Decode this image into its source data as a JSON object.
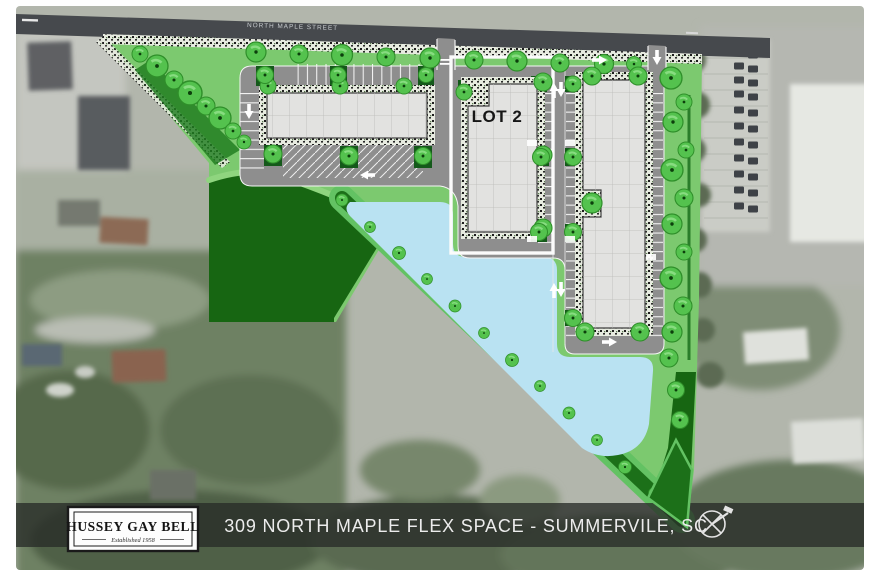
{
  "title_bar": {
    "text": "309 NORTH MAPLE FLEX SPACE - SUMMERVILE, SC"
  },
  "labels": {
    "street": "NORTH MAPLE STREET",
    "lot2": "LOT 2"
  },
  "logo": {
    "name": "HUSSEY GAY BELL",
    "tagline": "Established 1958"
  },
  "icons": {
    "north_arrow": "compass-north-arrow-icon"
  },
  "colors": {
    "site_lawn": "#7cc96f",
    "woods_green": "#176612",
    "buffer_band_green": "#1c7019",
    "pond_blue": "#b9e2f2",
    "asphalt_gray": "#8e8e8e",
    "road_gray": "#46494d",
    "building_gray": "#e2e2e0",
    "tree_green": "#54c24e",
    "selection_box": "#ffffff",
    "title_bar_bg": "rgba(40,44,40,0.78)"
  }
}
